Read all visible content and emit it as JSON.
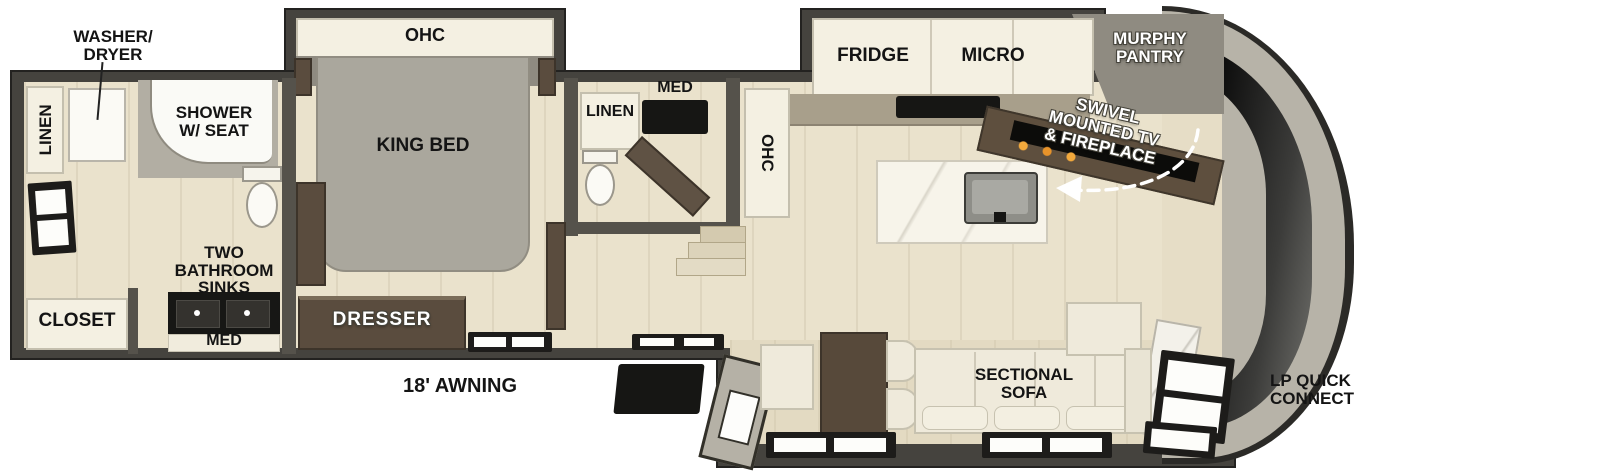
{
  "title": "RV travel trailer floorplan",
  "colors": {
    "wall": "#45433e",
    "floor": "#eae2cc",
    "cabinet": "#f4f0e2",
    "wood": "#5a4c3e",
    "sofa": "#efeadb",
    "flame": "#e8932a",
    "label": "#141414"
  },
  "labels": {
    "rear_bath": {
      "washer_dryer_1": "WASHER/",
      "washer_dryer_2": "DRYER",
      "linen": "LINEN",
      "shower_1": "SHOWER",
      "shower_2": "W/ SEAT",
      "sinks_1": "TWO",
      "sinks_2": "BATHROOM",
      "sinks_3": "SINKS",
      "med": "MED",
      "closet": "CLOSET"
    },
    "bedroom": {
      "ohc": "OHC",
      "king_bed": "KING BED",
      "dresser": "DRESSER"
    },
    "mid_bath": {
      "linen": "LINEN",
      "med": "MED"
    },
    "kitchen": {
      "ohc": "OHC",
      "fridge": "FRIDGE",
      "micro": "MICRO",
      "murphy_1": "MURPHY",
      "murphy_2": "PANTRY",
      "swivel_1": "SWIVEL",
      "swivel_2": "MOUNTED TV",
      "swivel_3": "& FIREPLACE"
    },
    "living": {
      "sofa_1": "SECTIONAL",
      "sofa_2": "SOFA"
    },
    "exterior": {
      "awning": "18' AWNING",
      "lp_1": "LP QUICK",
      "lp_2": "CONNECT"
    }
  }
}
